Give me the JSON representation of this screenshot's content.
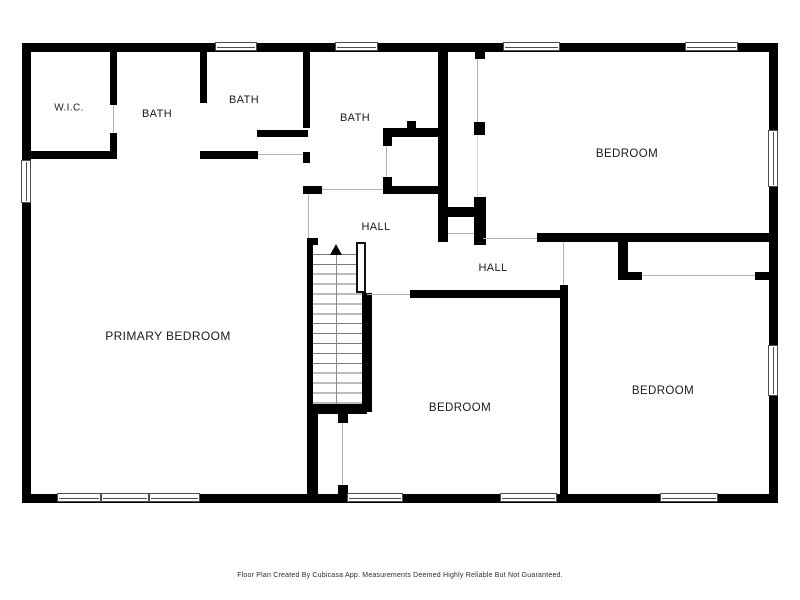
{
  "title": "Floor Plan",
  "colors": {
    "wall": "#000000",
    "floor": "#ffffff",
    "door_opening_line": "#b3b3b3",
    "window_frame": "#4d4d4d",
    "label_text": "#1a1a1a"
  },
  "rooms": [
    {
      "label": "W.I.C.",
      "x": 69,
      "y": 108,
      "font_size": 10
    },
    {
      "label": "BATH",
      "x": 157,
      "y": 114,
      "font_size": 11
    },
    {
      "label": "BATH",
      "x": 244,
      "y": 100,
      "font_size": 11
    },
    {
      "label": "BATH",
      "x": 355,
      "y": 118,
      "font_size": 11
    },
    {
      "label": "BEDROOM",
      "x": 627,
      "y": 154,
      "font_size": 11.5
    },
    {
      "label": "HALL",
      "x": 376,
      "y": 227,
      "font_size": 11
    },
    {
      "label": "HALL",
      "x": 493,
      "y": 268,
      "font_size": 11
    },
    {
      "label": "PRIMARY BEDROOM",
      "x": 168,
      "y": 336,
      "font_size": 12
    },
    {
      "label": "BEDROOM",
      "x": 460,
      "y": 408,
      "font_size": 11.5
    },
    {
      "label": "BEDROOM",
      "x": 663,
      "y": 391,
      "font_size": 11.5
    }
  ],
  "stairs": {
    "direction": "up",
    "treads": 16
  },
  "footer": {
    "text": "Floor Plan Created By Cubicasa App. Measurements Deemed Highly Reliable But Not Guaranteed."
  }
}
